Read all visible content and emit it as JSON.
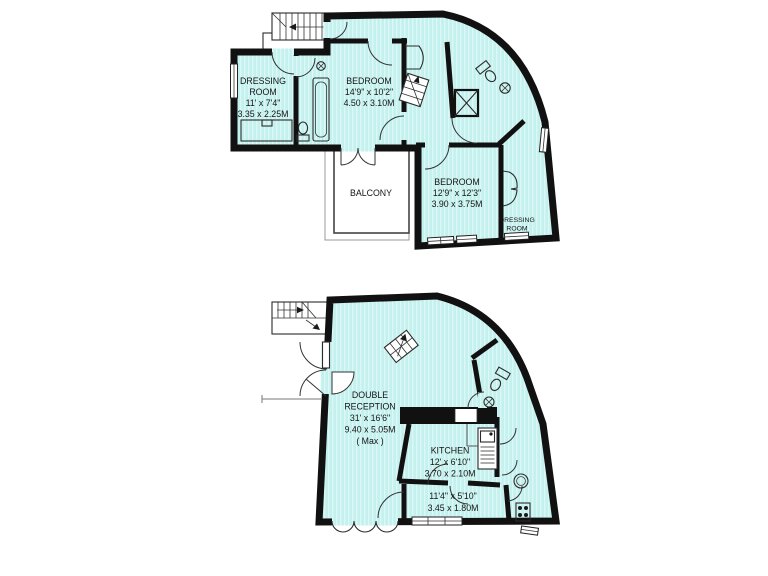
{
  "colors": {
    "room_fill": "#c4f0ee",
    "room_stripe": "#daf8f6",
    "wall": "#111111",
    "background": "#ffffff"
  },
  "upper_floor": {
    "dressing_room": {
      "name": "DRESSING",
      "name2": "ROOM",
      "imperial": "11' x 7'4\"",
      "metric": "3.35 x 2.25M"
    },
    "bedroom_front": {
      "name": "BEDROOM",
      "imperial": "14'9\" x 10'2\"",
      "metric": "4.50 x 3.10M"
    },
    "balcony": {
      "name": "BALCONY"
    },
    "bedroom_rear": {
      "name": "BEDROOM",
      "imperial": "12'9\" x 12'3\"",
      "metric": "3.90 x 3.75M"
    },
    "dressing_room_2": {
      "name": "DRESSING",
      "name2": "ROOM"
    }
  },
  "lower_floor": {
    "double_reception": {
      "name": "DOUBLE",
      "name2": "RECEPTION",
      "imperial": "31' x 16'6\"",
      "metric": "9.40 x 5.05M",
      "note": "( Max )"
    },
    "kitchen": {
      "name": "KITCHEN",
      "imperial": "12' x 6'10\"",
      "metric": "3.70 x 2.10M"
    },
    "hallway": {
      "imperial": "11'4\" x 5'10\"",
      "metric": "3.45 x 1.80M"
    }
  }
}
